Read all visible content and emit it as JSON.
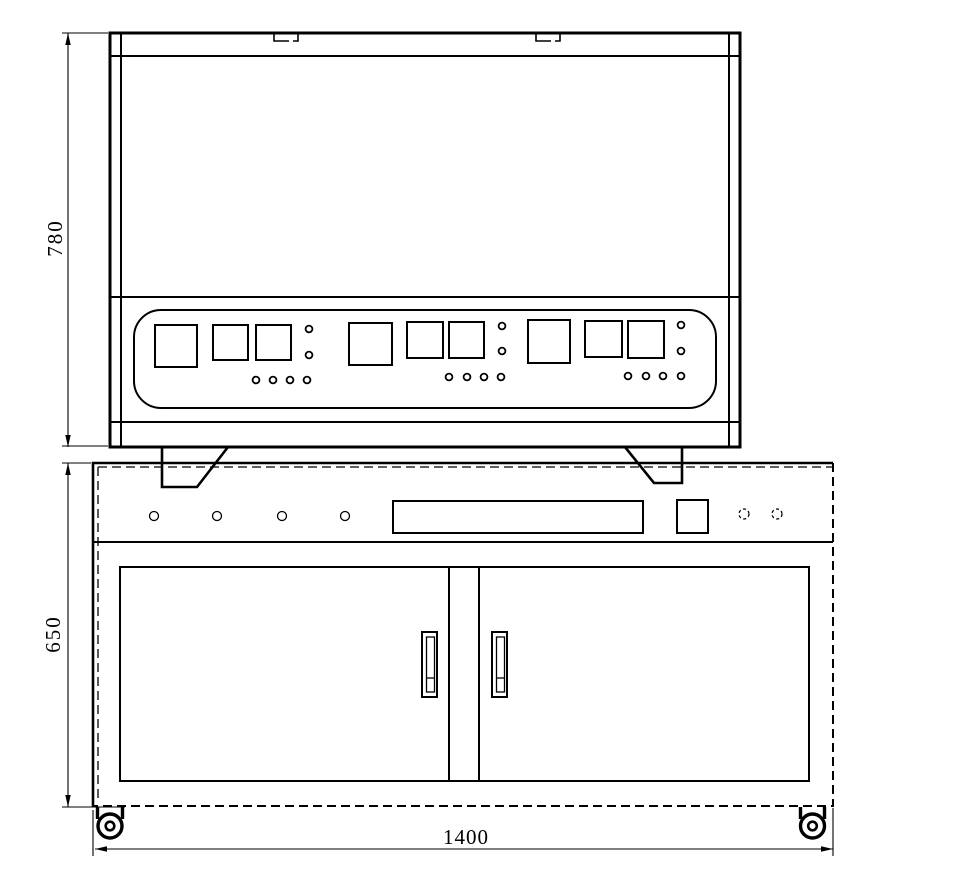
{
  "drawing": {
    "type": "technical-drawing",
    "dimensions": {
      "top_unit_height": "780",
      "base_cabinet_height": "650",
      "base_cabinet_width": "1400"
    },
    "colors": {
      "line": "#000000",
      "background": "#ffffff"
    }
  }
}
